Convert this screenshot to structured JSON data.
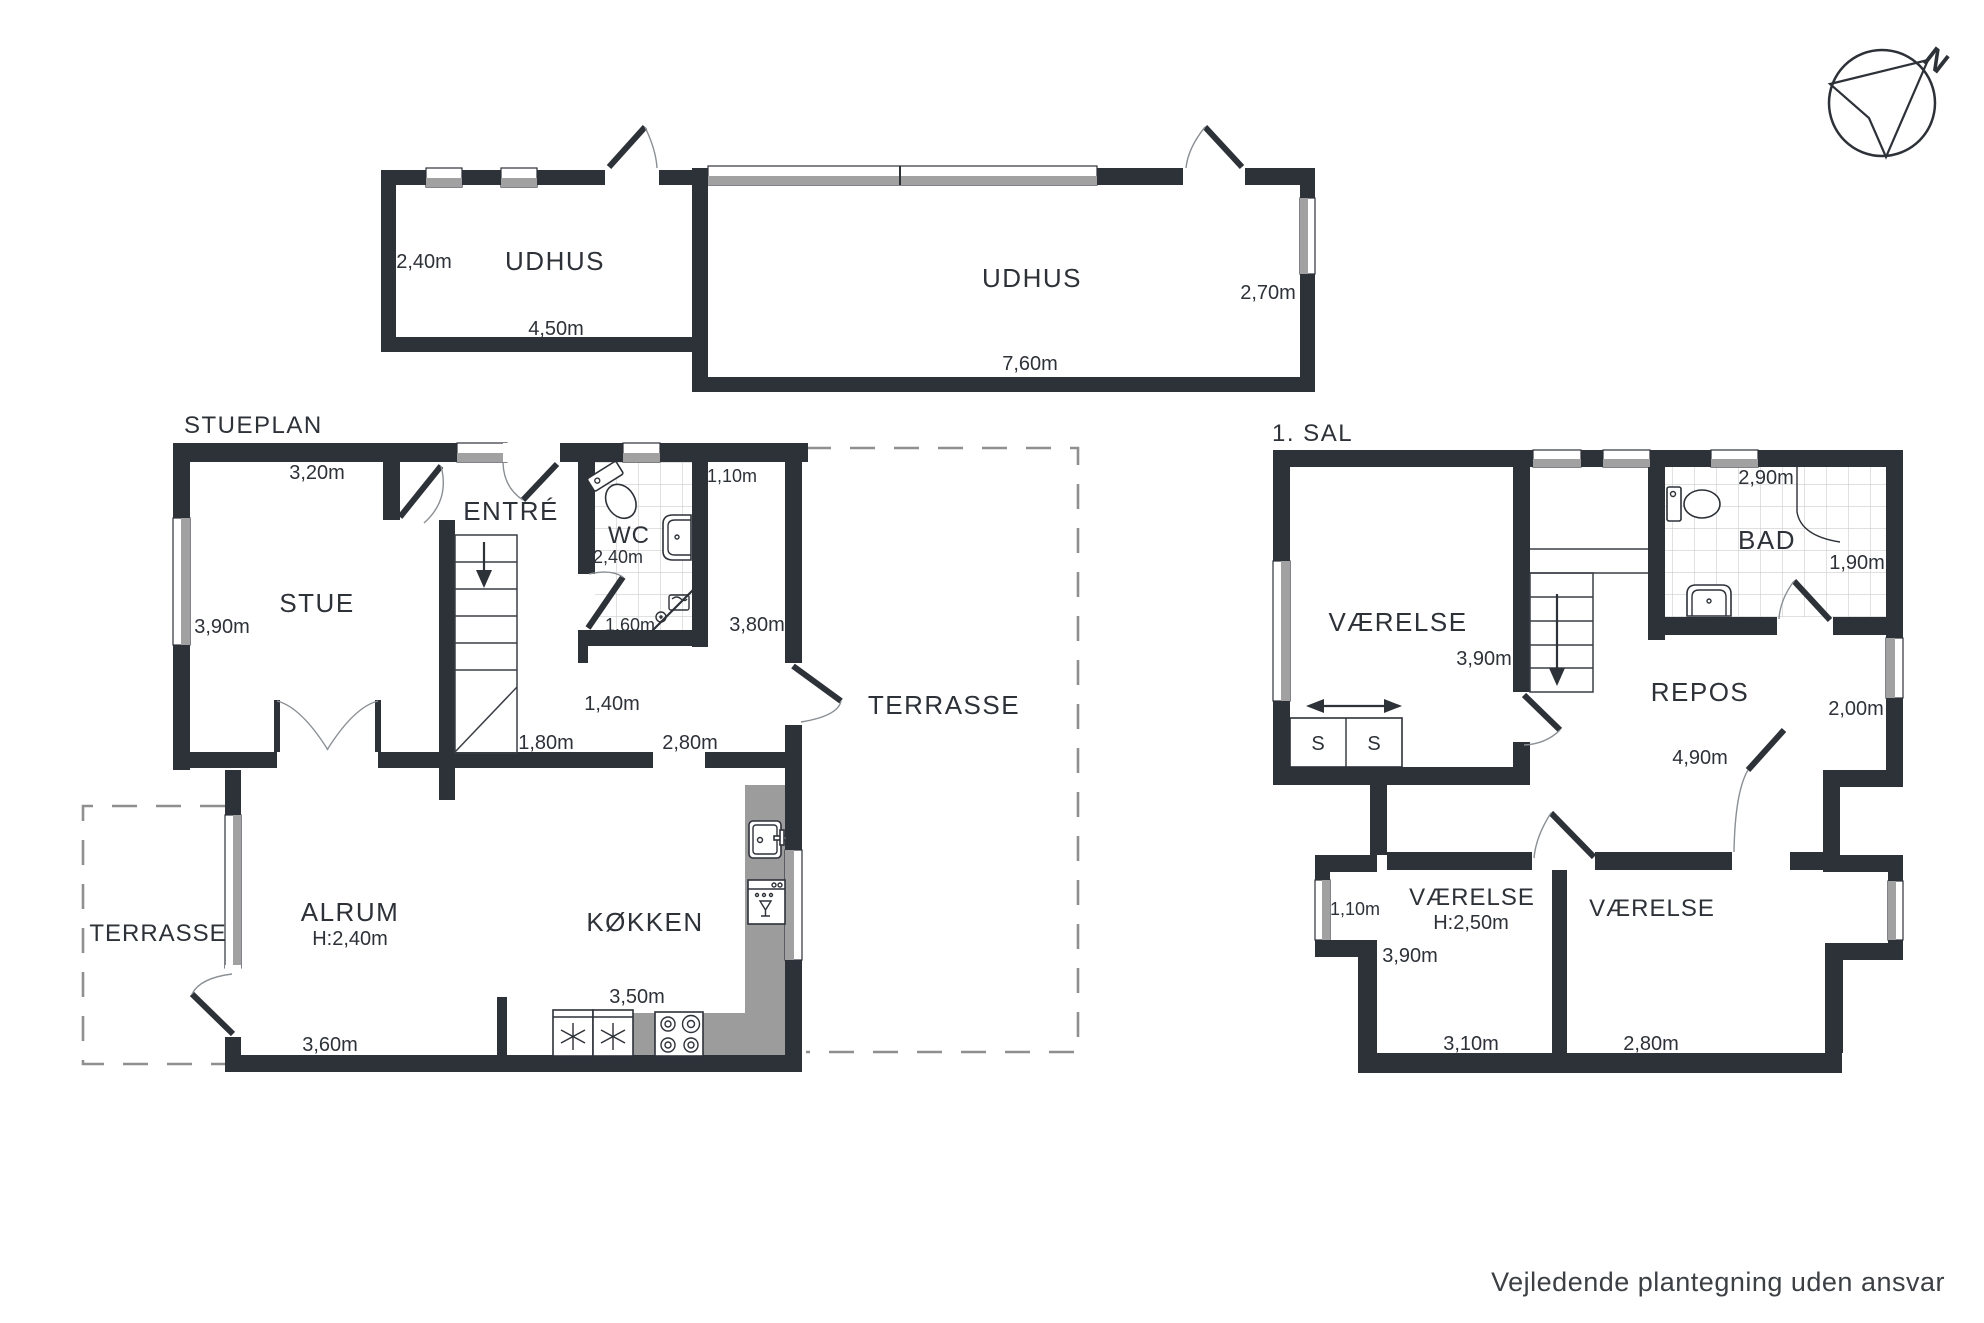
{
  "colors": {
    "wall": "#2d3138",
    "window_gray": "#a1a1a1",
    "counter_gray": "#9c9c9c",
    "dash_gray": "#8f8f8f",
    "tile_line": "#cdcdcd",
    "text": "#2d3138"
  },
  "compass": {
    "north_label": "N"
  },
  "footer": {
    "disclaimer": "Vejledende plantegning uden ansvar"
  },
  "outbuilding": {
    "room_left": {
      "name": "UDHUS",
      "depth": "2,40m",
      "width": "4,50m"
    },
    "room_right": {
      "name": "UDHUS",
      "width": "7,60m",
      "depth": "2,70m"
    }
  },
  "ground_floor": {
    "title": "STUEPLAN",
    "stue": {
      "name": "STUE",
      "width": "3,20m",
      "depth": "3,90m"
    },
    "entre": {
      "name": "ENTRÉ"
    },
    "wc": {
      "name": "WC",
      "width": "2,40m",
      "width2": "1,60m"
    },
    "hall": {
      "width": "1,10m",
      "depth": "3,80m",
      "dim1": "1,40m",
      "dim2": "1,80m",
      "dim3": "2,80m"
    },
    "alrum": {
      "name": "ALRUM",
      "ceiling": "H:2,40m",
      "width": "3,60m"
    },
    "kokken": {
      "name": "KØKKEN",
      "width": "3,50m"
    },
    "terrasse_left": {
      "name": "TERRASSE"
    },
    "terrasse_right": {
      "name": "TERRASSE"
    }
  },
  "first_floor": {
    "title": "1. SAL",
    "vaerelse_nw": {
      "name": "VÆRELSE",
      "depth": "3,90m",
      "closet_s1": "S",
      "closet_s2": "S"
    },
    "bad": {
      "name": "BAD",
      "width": "2,90m",
      "depth": "1,90m"
    },
    "repos": {
      "name": "REPOS",
      "width": "4,90m",
      "dim": "2,00m"
    },
    "vaerelse_sw": {
      "name": "VÆRELSE",
      "ceiling": "H:2,50m",
      "dormer": "1,10m",
      "depth": "3,90m",
      "width": "3,10m"
    },
    "vaerelse_se": {
      "name": "VÆRELSE",
      "width": "2,80m"
    }
  }
}
